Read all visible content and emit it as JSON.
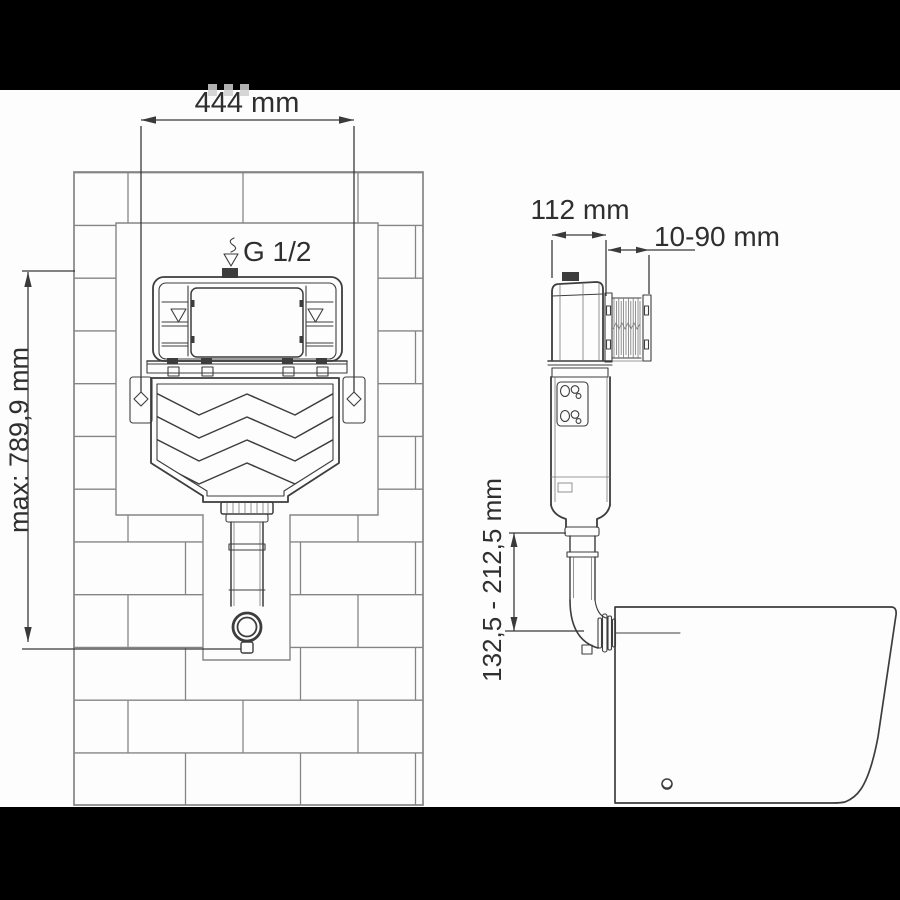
{
  "colors": {
    "bg": "#000000",
    "paper": "#fdfdfd",
    "line": "#3d3d3d",
    "lineLight": "#787878",
    "brick": "#858585",
    "dim": "#3a3a3a",
    "text": "#2f2f2f"
  },
  "front_view": {
    "width_label": "444 mm",
    "height_label": "max: 789,9 mm",
    "inlet_label": "G 1/2"
  },
  "side_view": {
    "depth_label": "112 mm",
    "wall_distance_label": "10-90 mm",
    "outlet_height_label": "132,5 - 212,5 mm"
  }
}
